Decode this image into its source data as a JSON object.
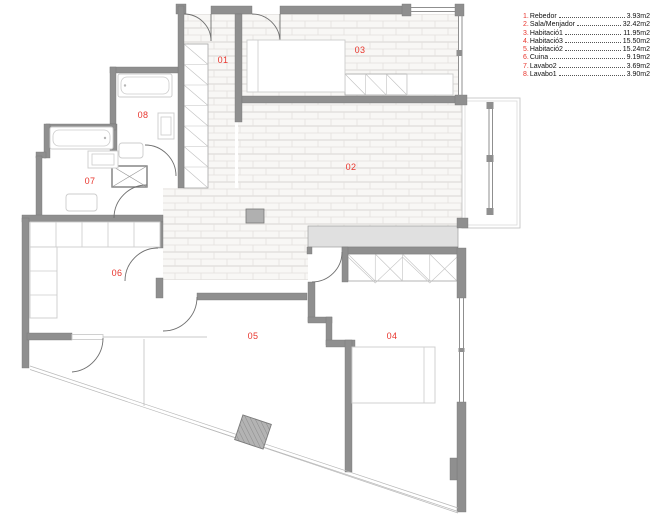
{
  "title": "Floor plan",
  "colors": {
    "red": "#e8362e",
    "wall": "#8f8f8f",
    "band": "#e0e0e0",
    "tile_line": "#e3e1de"
  },
  "legend": {
    "items": [
      {
        "num": "1.",
        "name": "Rebedor",
        "area": "3.93m2"
      },
      {
        "num": "2.",
        "name": "Sala/Menjador",
        "area": "32.42m2"
      },
      {
        "num": "3.",
        "name": "Habitació1",
        "area": "11.95m2"
      },
      {
        "num": "4.",
        "name": "Habitació3",
        "area": "15.50m2"
      },
      {
        "num": "5.",
        "name": "Habitació2",
        "area": "15.24m2"
      },
      {
        "num": "6.",
        "name": "Cuina",
        "area": "9.19m2"
      },
      {
        "num": "7.",
        "name": "Lavabo2",
        "area": "3.69m2"
      },
      {
        "num": "8.",
        "name": "Lavabo1",
        "area": "3.90m2"
      }
    ]
  },
  "plan": {
    "rooms": [
      {
        "id": "01",
        "x": 223,
        "y": 63
      },
      {
        "id": "02",
        "x": 351,
        "y": 170
      },
      {
        "id": "03",
        "x": 360,
        "y": 53
      },
      {
        "id": "04",
        "x": 392,
        "y": 339
      },
      {
        "id": "05",
        "x": 253,
        "y": 339
      },
      {
        "id": "06",
        "x": 117,
        "y": 276
      },
      {
        "id": "07",
        "x": 90,
        "y": 184
      },
      {
        "id": "08",
        "x": 143,
        "y": 118
      }
    ]
  }
}
